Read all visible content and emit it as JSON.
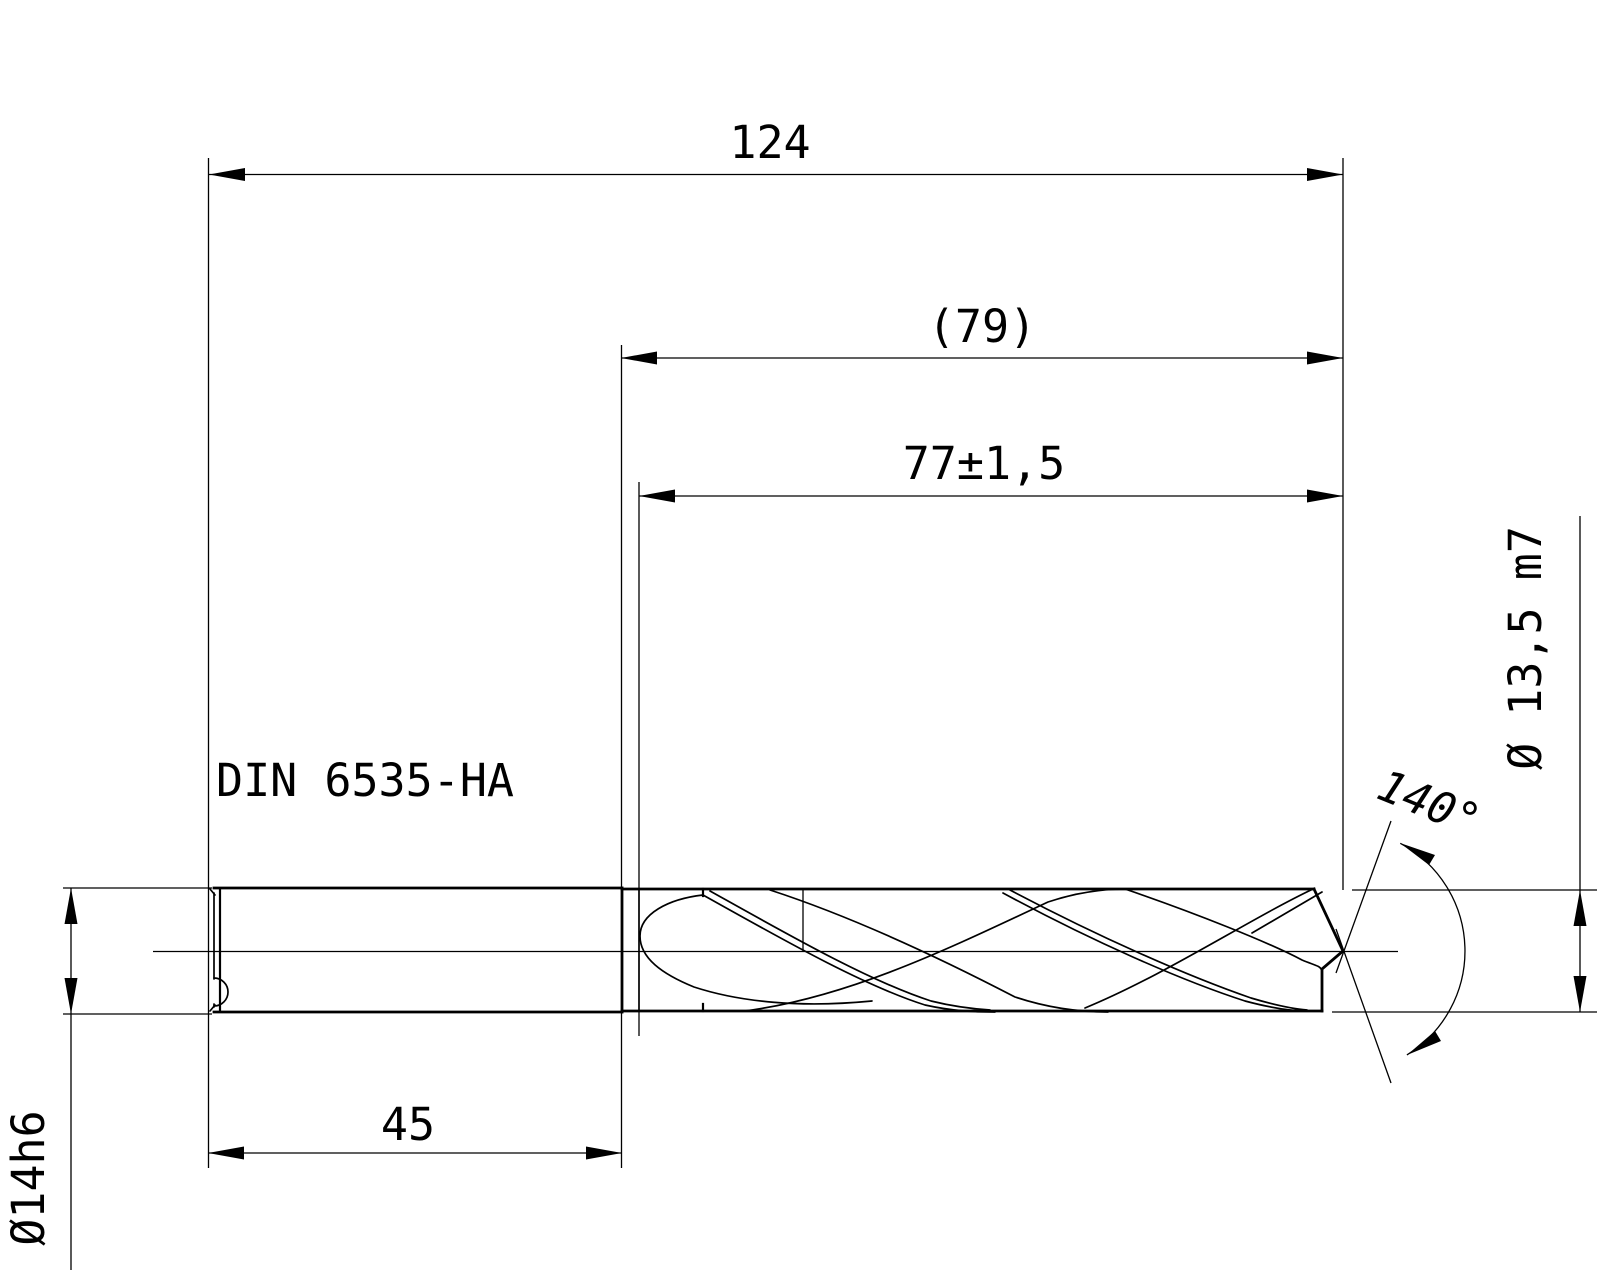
{
  "drawing": {
    "type_label": "technical-drawing-twist-drill",
    "background_color": "#ffffff",
    "line_color": "#000000",
    "shank_standard_label": "DIN 6535-HA",
    "dimensions": {
      "overall_length": "124",
      "shank_plus_flute_length": "(79)",
      "flute_length": "77±1,5",
      "shank_length": "45",
      "shank_diameter": "Ø14h6",
      "cutting_diameter": "Ø 13,5 m7",
      "point_angle": "140°"
    }
  }
}
